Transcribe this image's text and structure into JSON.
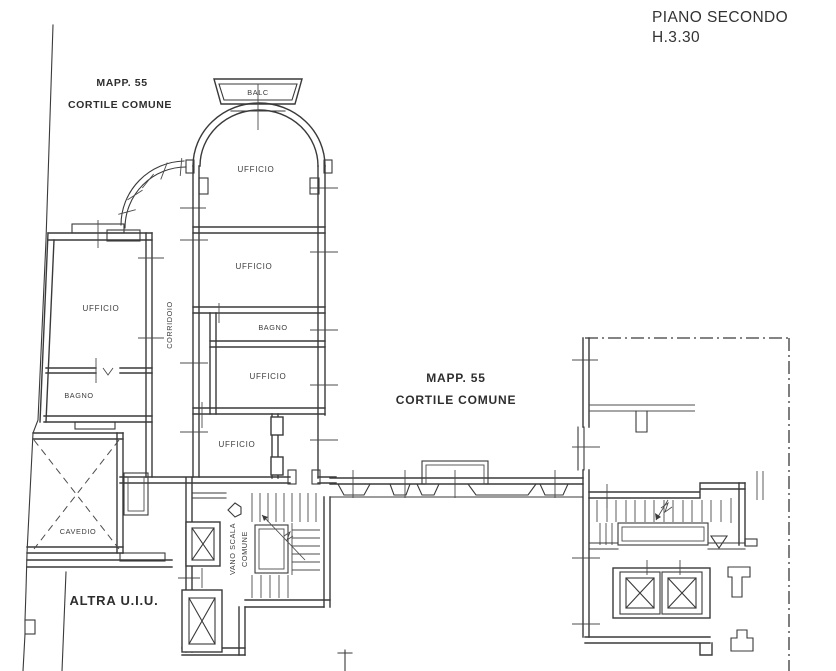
{
  "header": {
    "title": "PIANO SECONDO",
    "height_note": "H.3.30"
  },
  "annotations": {
    "courtyard_top": {
      "line1": "MAPP. 55",
      "line2": "CORTILE COMUNE"
    },
    "courtyard_center": {
      "line1": "MAPP. 55",
      "line2": "CORTILE COMUNE"
    },
    "other_unit": "ALTRA U.I.U."
  },
  "rooms": {
    "balcony": "BALC",
    "office_north": "UFFICIO",
    "office_2": "UFFICIO",
    "bathroom_center": "BAGNO",
    "office_3": "UFFICIO",
    "office_4": "UFFICIO",
    "office_west": "UFFICIO",
    "bathroom_west": "BAGNO",
    "corridor": "CORRIDOIO",
    "lightwell": "CAVEDIO",
    "stairwell_line1": "VANO SCALA",
    "stairwell_line2": "COMUNE"
  },
  "colors": {
    "line": "#3a3a3a",
    "background": "#ffffff",
    "text": "#2e2e2e"
  }
}
